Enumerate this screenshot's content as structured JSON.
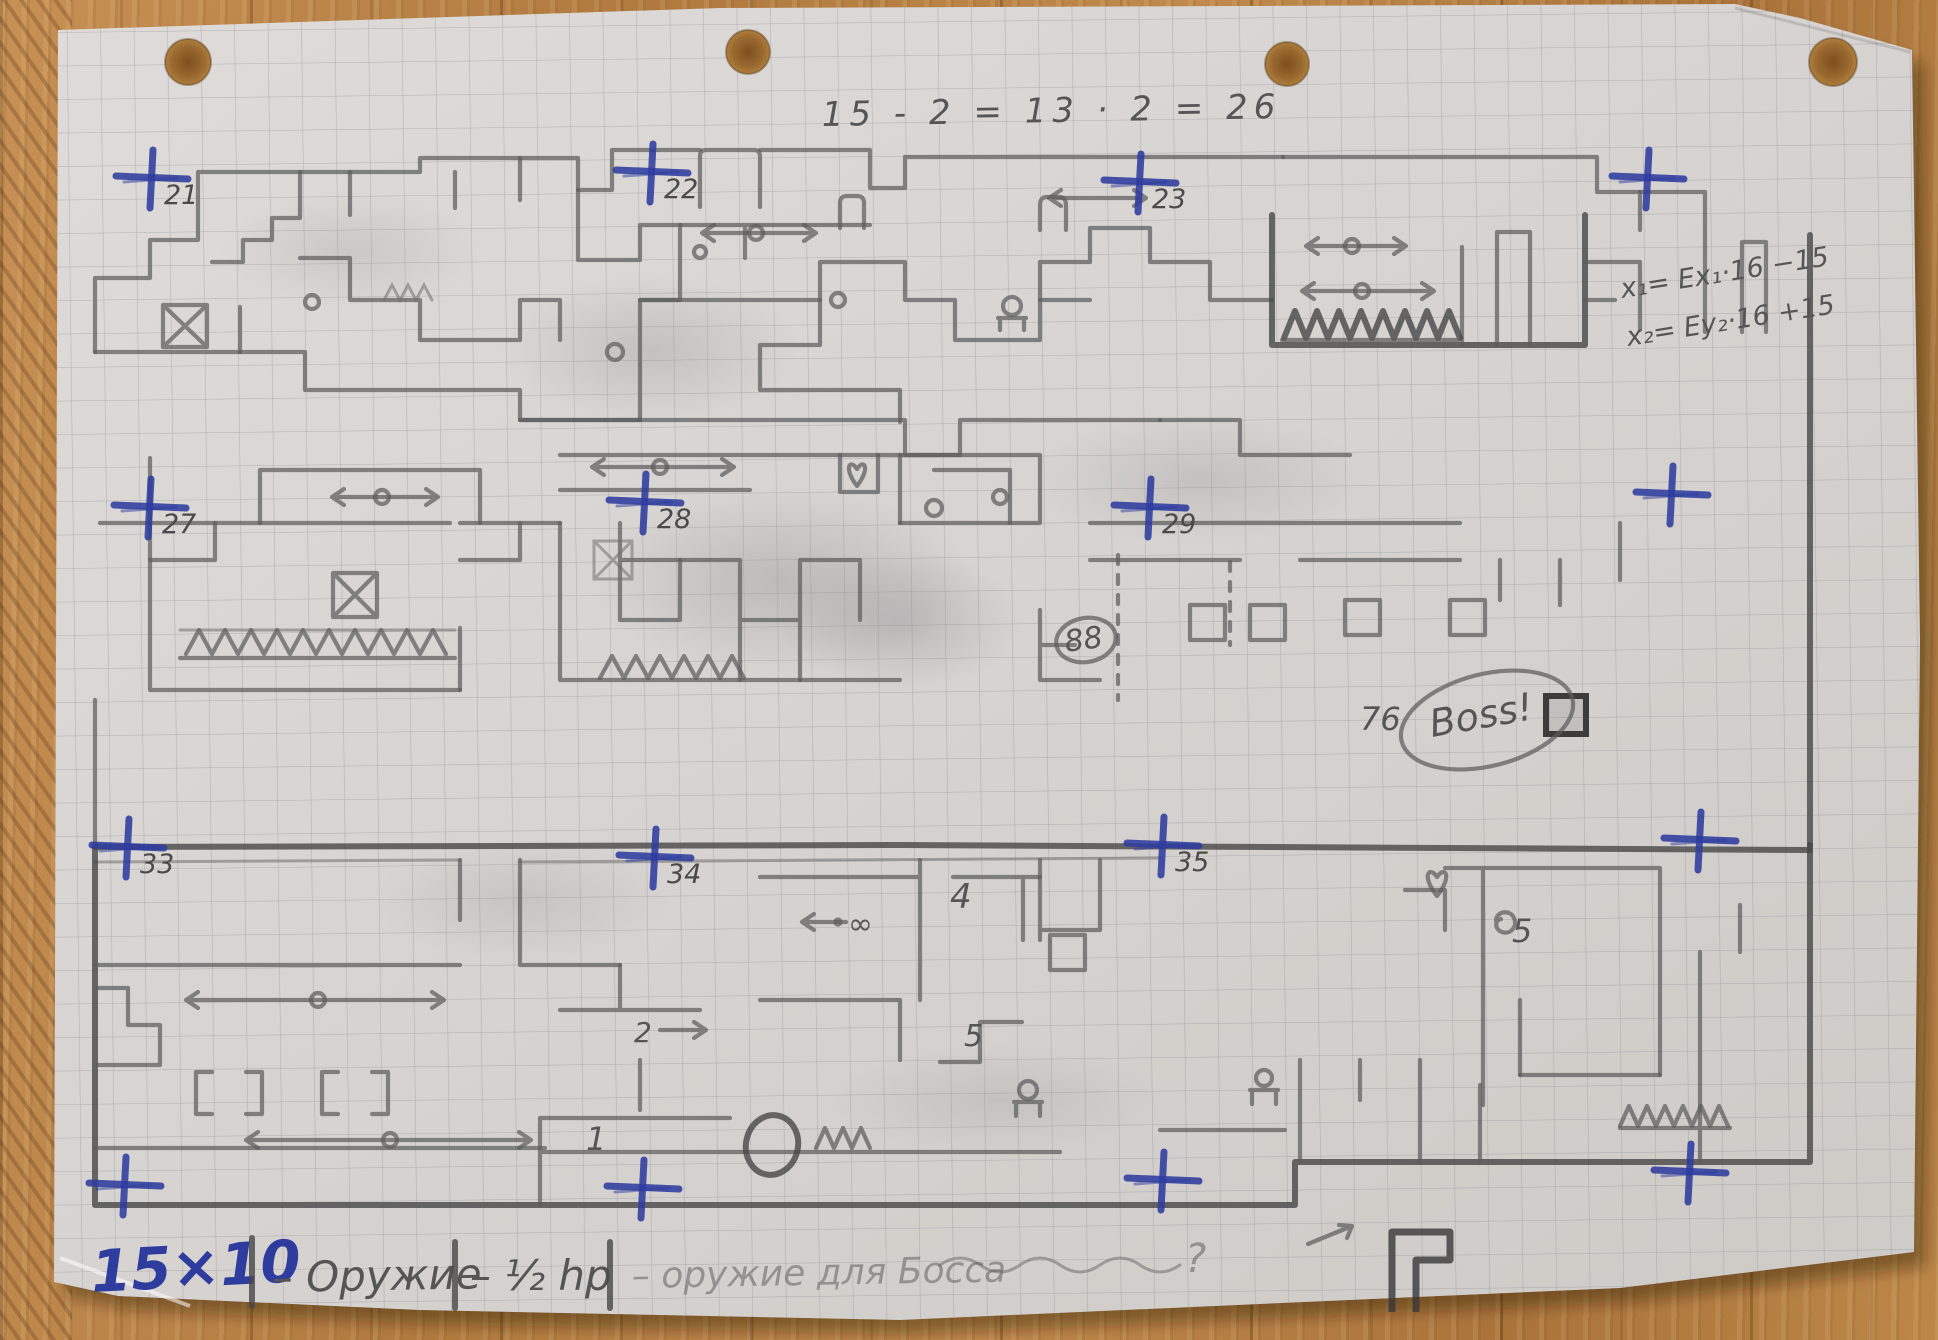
{
  "photo": {
    "paper_color": "#d9d6d2",
    "grid_color": "#69707d",
    "pencil_color": "#5d5d5d",
    "pen_color": "#2e3c9e",
    "wood_color": "#b5854e"
  },
  "annotations": {
    "equation": "15 - 2 = 13 · 2 = 26",
    "formula1": "x₁= Ex₁·16 −15",
    "formula2": "x₂= Ey₂·16 +15",
    "boss": "Boss!",
    "num76": "76",
    "num88": "88",
    "num1": "1",
    "num2": "2",
    "num4": "4",
    "num5": "5",
    "num5b": "5",
    "infinity": "∞"
  },
  "legend": {
    "size_label": "15×10",
    "items": [
      "– Оружие",
      "– ½ hp",
      "– оружие для Босса",
      "?"
    ]
  },
  "markers": [
    {
      "label": "21",
      "x": 152,
      "y": 176
    },
    {
      "label": "22",
      "x": 652,
      "y": 170
    },
    {
      "label": "23",
      "x": 1140,
      "y": 180
    },
    {
      "label": "",
      "x": 1648,
      "y": 176
    },
    {
      "label": "27",
      "x": 150,
      "y": 505
    },
    {
      "label": "28",
      "x": 645,
      "y": 500
    },
    {
      "label": "29",
      "x": 1150,
      "y": 505
    },
    {
      "label": "",
      "x": 1672,
      "y": 492
    },
    {
      "label": "33",
      "x": 128,
      "y": 845
    },
    {
      "label": "34",
      "x": 655,
      "y": 855
    },
    {
      "label": "35",
      "x": 1163,
      "y": 843
    },
    {
      "label": "",
      "x": 1700,
      "y": 838
    },
    {
      "label": "",
      "x": 125,
      "y": 1183
    },
    {
      "label": "",
      "x": 643,
      "y": 1186
    },
    {
      "label": "",
      "x": 1163,
      "y": 1178
    },
    {
      "label": "",
      "x": 1690,
      "y": 1170
    }
  ]
}
